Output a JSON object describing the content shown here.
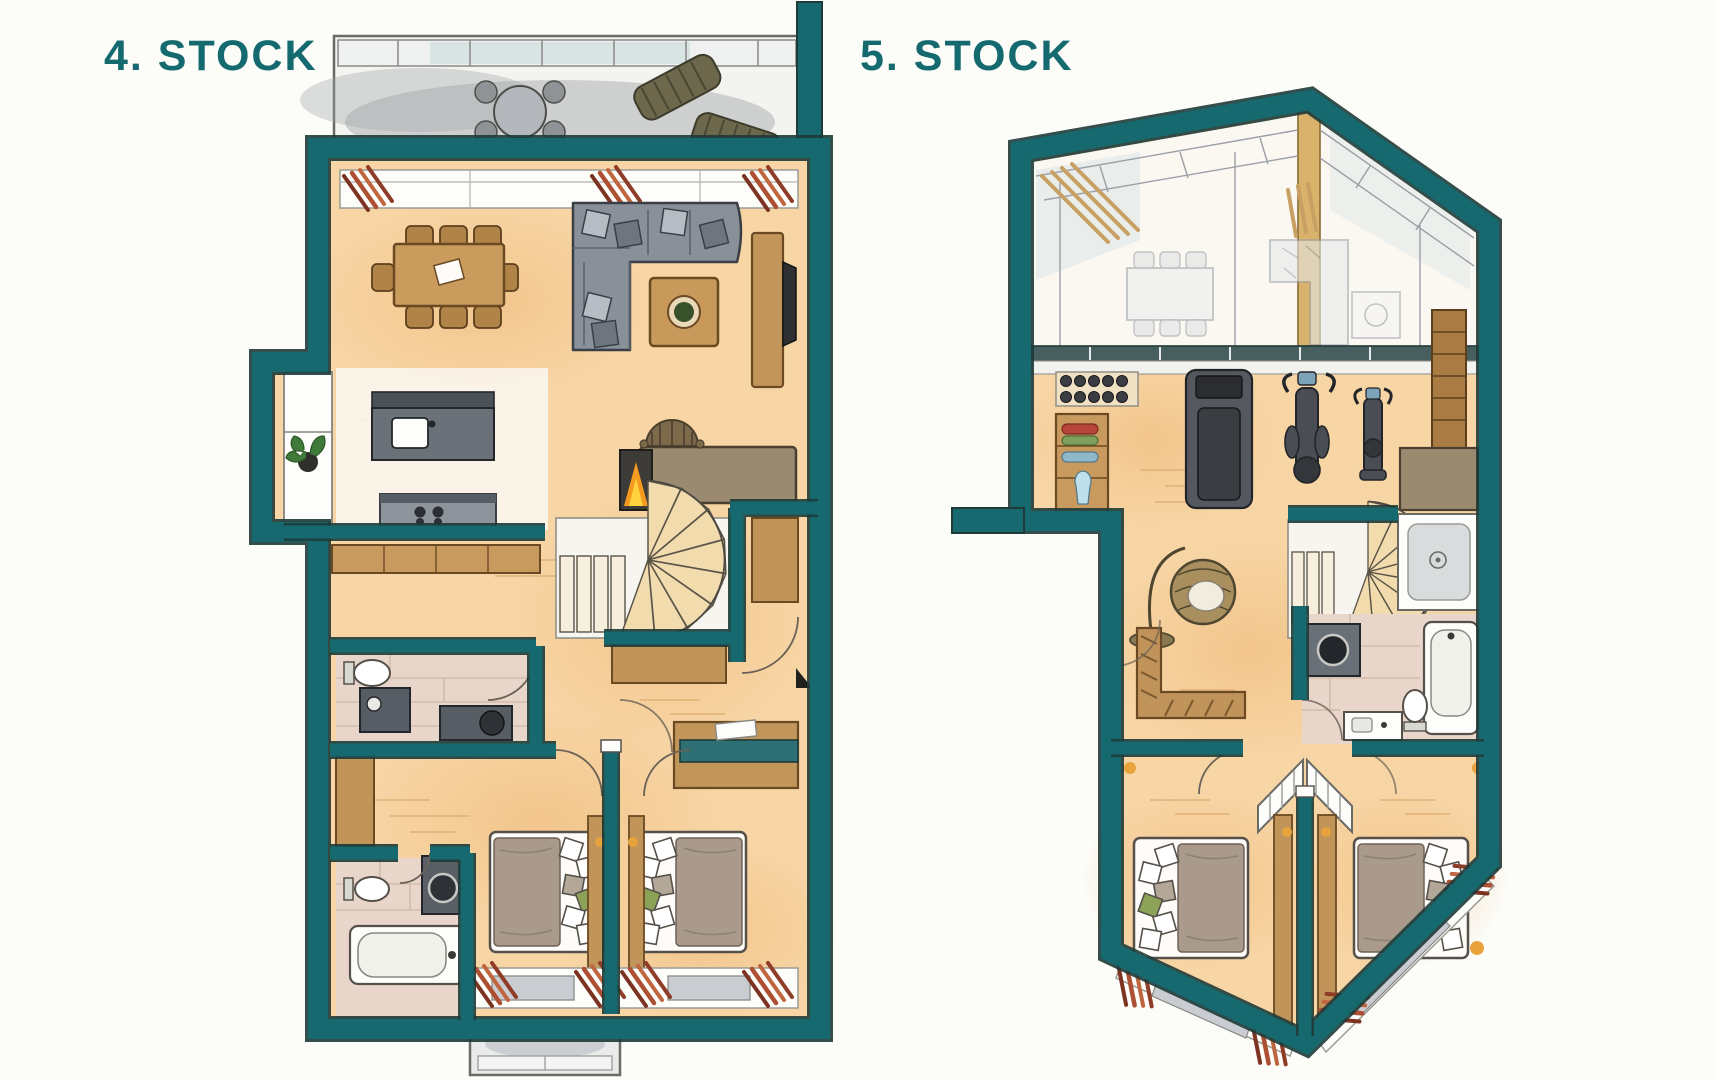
{
  "page": {
    "background_color": "#fcfcf9"
  },
  "titles": {
    "floor4_label": "4. STOCK",
    "floor5_label": "5. STOCK"
  },
  "colors": {
    "title_text": "#156a70",
    "wall_teal": "#15696f",
    "wall_outline": "#1e3b38",
    "floor_orange": "#f7d5a5",
    "floor_wash": "#eeb877",
    "tile_beige": "#e9d6ca",
    "wood_tan": "#c5975c",
    "wood_dark": "#6f4e26",
    "furniture_gray": "#8d939c",
    "furniture_gray_light": "#b9bec5",
    "balcony_gray": "#c3c6c9",
    "curtain_red": "#ad4f33",
    "pillow_green": "#8ba257",
    "pillow_taupe": "#b3a897",
    "flame_orange": "#f59a1f",
    "plant_green": "#3f7a3a",
    "lamp_yellow": "#e8a33d",
    "ghost_gray": "#9aa0a6"
  },
  "floor4": {
    "label": "4. STOCK",
    "features": [
      "roof-terrace",
      "lounge-chairs",
      "terrace-round-table",
      "dining-table-with-8-chairs",
      "l-shaped-sofa",
      "coffee-table",
      "sideboard-with-tv",
      "kitchen-island-with-sink",
      "cooktop",
      "bay-window-with-plant",
      "fireplace",
      "fireside-armchair",
      "spiral-staircase",
      "hall-wardrobe",
      "wc-with-toilet-and-vanity",
      "bathroom-with-toilet",
      "washing-machine",
      "bathtub",
      "double-bed-left",
      "double-bed-right",
      "bedroom-desk",
      "bedroom-windows-with-curtains",
      "lower-balcony"
    ]
  },
  "floor5": {
    "label": "5. STOCK",
    "features": [
      "double-height-gallery",
      "glass-roof-with-ridge",
      "gallery-railing",
      "ghost-dining-table-below",
      "ghost-sofa-below",
      "curtains",
      "dumbbell-rack",
      "towel-shelf",
      "treadmill",
      "elliptical-trainer",
      "exercise-bike",
      "bookshelf",
      "corner-sideboard",
      "hanging-egg-chair",
      "l-shaped-bench",
      "spiral-staircase",
      "shower",
      "washing-machine",
      "bathtub",
      "toilet",
      "washbasin-counter",
      "bed-left",
      "bed-right",
      "wardrobes",
      "stair-roof-entry",
      "bedroom-windows-with-curtains"
    ]
  }
}
